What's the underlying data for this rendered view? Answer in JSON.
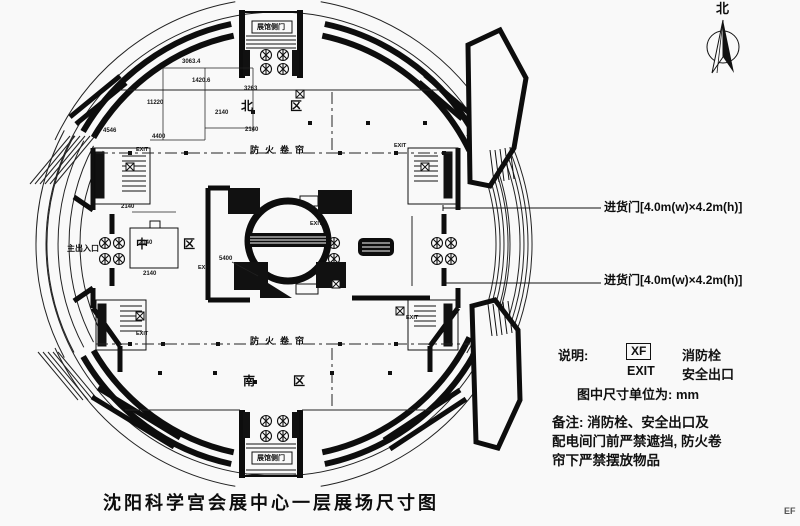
{
  "title": "沈阳科学宫会展中心一层展场尺寸图",
  "watermark": "EF",
  "compass": {
    "north": "北"
  },
  "callouts": {
    "loading_door_top": "进货门[4.0m(w)×4.2m(h)]",
    "loading_door_bottom": "进货门[4.0m(w)×4.2m(h)]"
  },
  "legend": {
    "heading": "说明:",
    "hydrant_symbol": "XF",
    "hydrant_label": "消防栓",
    "exit_symbol": "EXIT",
    "exit_label": "安全出口",
    "units_label": "图中尺寸单位为:",
    "units_value": "mm"
  },
  "notes": {
    "line1": "备注: 消防栓、安全出口及",
    "line2": "配电间门前严禁遮挡, 防火卷",
    "line3": "帘下严禁摆放物品"
  },
  "plan": {
    "area_north": "北区",
    "area_middle": "中区",
    "area_south": "南区",
    "main_entrance": "主出入口",
    "side_door_top": "展馆侧门",
    "side_door_bottom": "展馆侧门",
    "fire_shutter_north": "防火卷帘",
    "fire_shutter_south": "防火卷帘",
    "exit": "EXIT",
    "dims": [
      "3063.4",
      "1420.6",
      "11220",
      "3263",
      "2140",
      "2140",
      "4400",
      "4546",
      "2140",
      "2140",
      "5400",
      "2140"
    ]
  }
}
